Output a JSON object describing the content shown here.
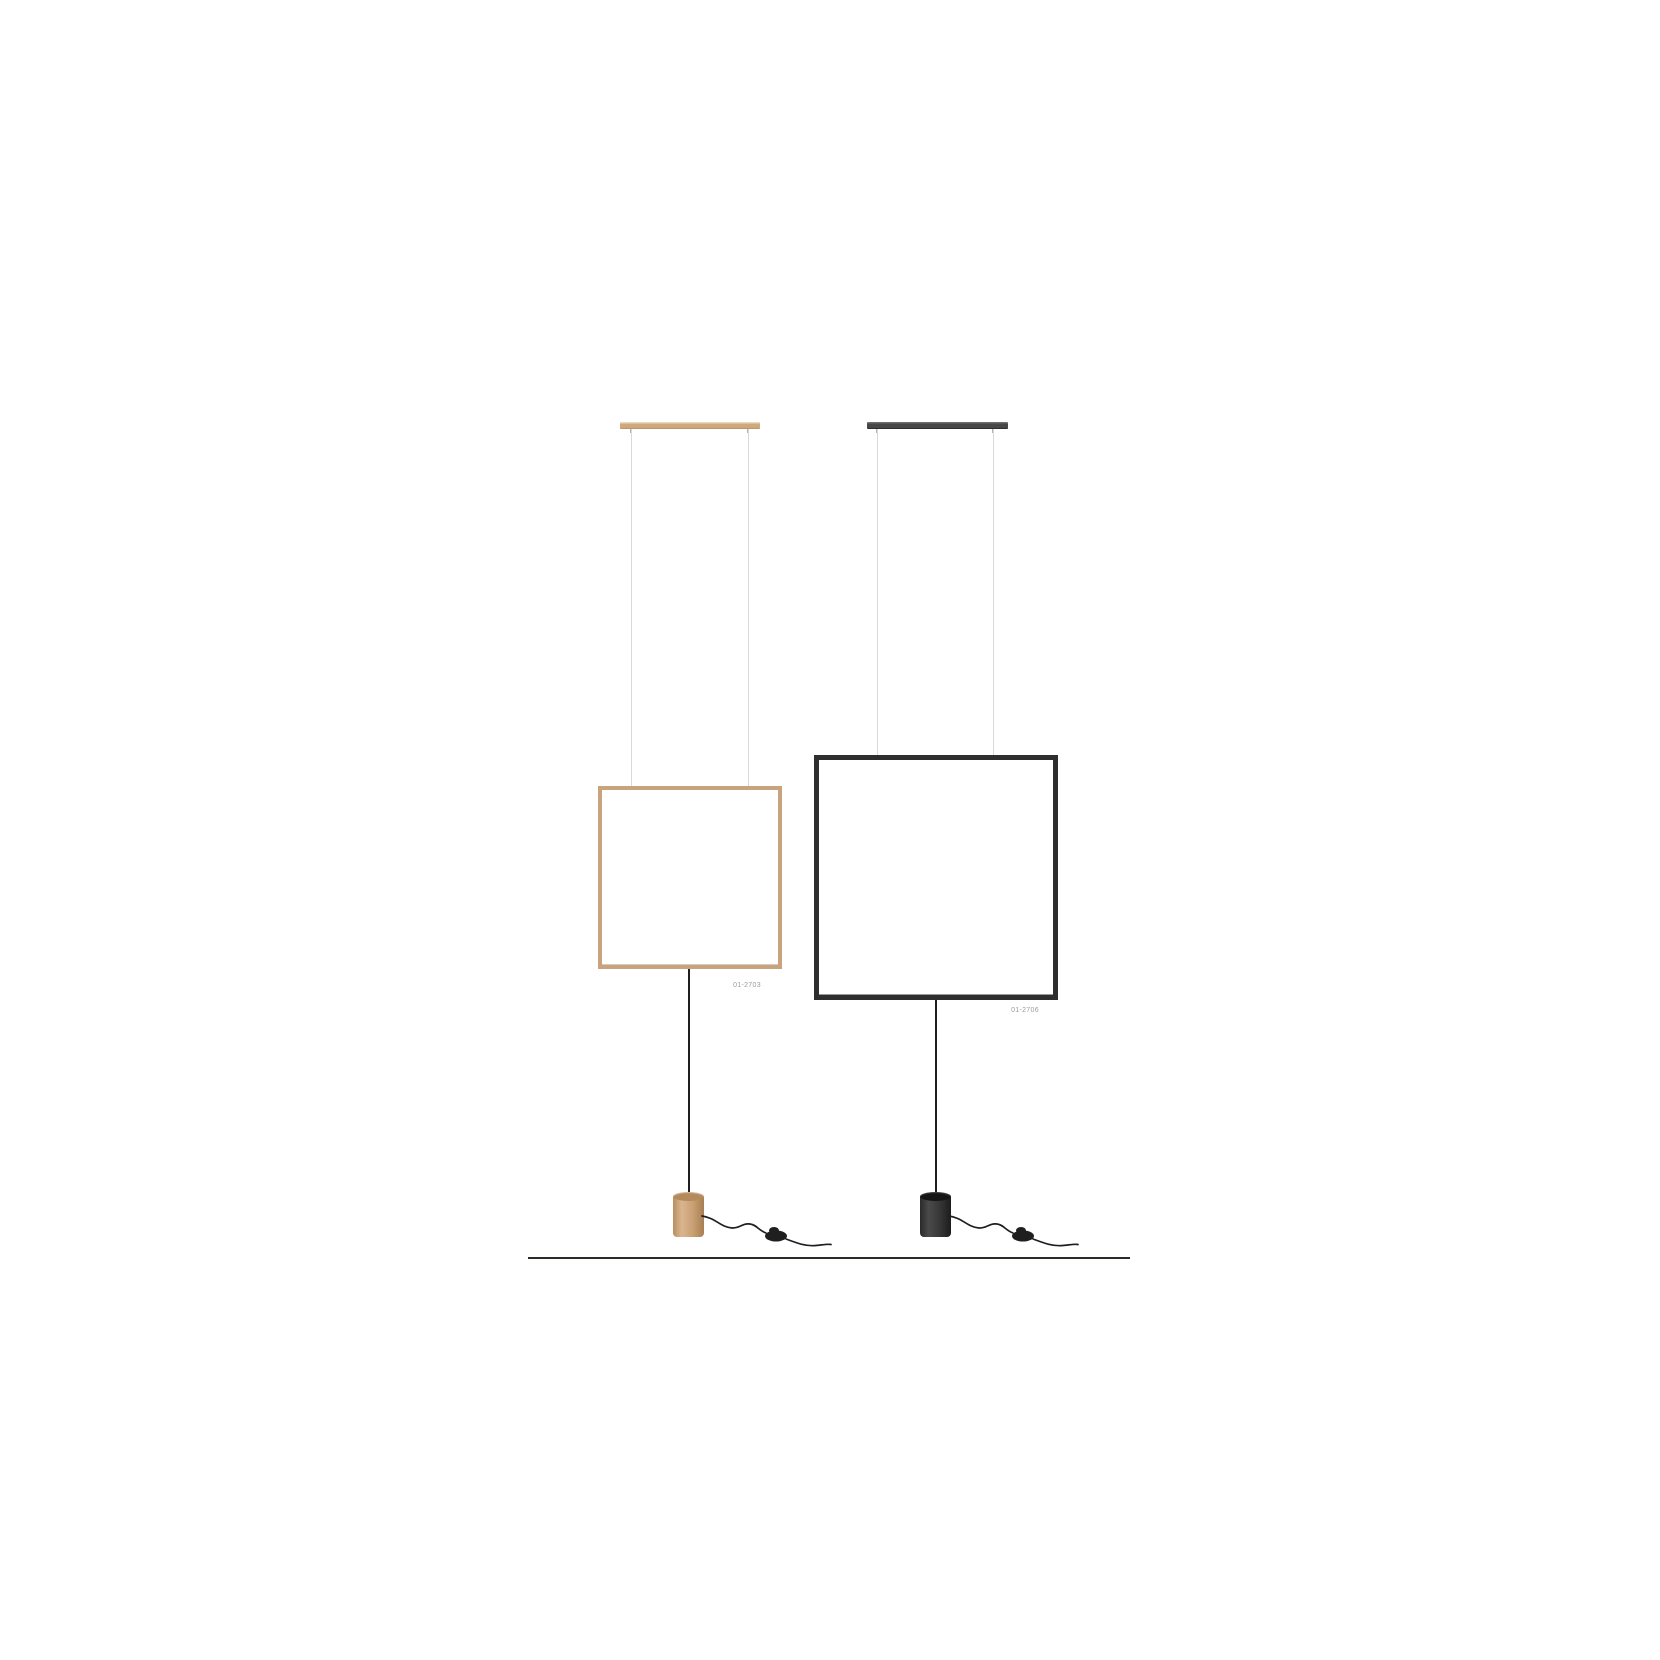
{
  "colors": {
    "wood-bar": "#cfa87e",
    "wood-bar-light": "#ead7bc",
    "wood-bar-dark": "#b58c62",
    "wood-frame": "#c9a27e",
    "black-bar": "#474747",
    "black-bar-light": "#6e6e6e",
    "black-frame": "#2e2e2e",
    "wire": "#d9d9d9",
    "pin": "#b3b3b3",
    "cord": "#1f1f1f",
    "floor": "#2b2b26",
    "label": "#9b9b9b"
  },
  "products": [
    {
      "model_code": "01-2703",
      "finish_color": "#c9a27e"
    },
    {
      "model_code": "01-2706",
      "finish_color": "#2e2e2e"
    }
  ]
}
